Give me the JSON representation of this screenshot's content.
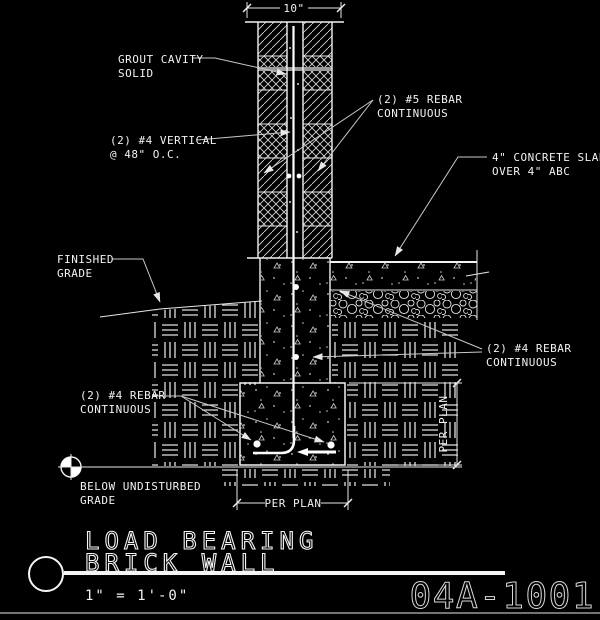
{
  "title_block": {
    "detail_title_line1": "LOAD BEARING",
    "detail_title_line2": "BRICK WALL",
    "scale": "1\" = 1'-0\"",
    "sheet_number": "04A-1001"
  },
  "dimensions": {
    "wall_width": "10\"",
    "footing_width": "PER PLAN",
    "footing_depth": "PER PLAN"
  },
  "callouts": {
    "grout": {
      "l1": "GROUT CAVITY",
      "l2": "SOLID"
    },
    "rebar5": {
      "l1": "(2) #5 REBAR",
      "l2": "CONTINUOUS"
    },
    "vert4": {
      "l1": "(2) #4 VERTICAL",
      "l2": "@ 48\" O.C."
    },
    "slab": {
      "l1": "4\" CONCRETE SLAB",
      "l2": "OVER 4\" ABC"
    },
    "fin_grade": {
      "l1": "FINISHED",
      "l2": "GRADE"
    },
    "rebar4_right": {
      "l1": "(2) #4 REBAR",
      "l2": "CONTINUOUS"
    },
    "rebar4_left": {
      "l1": "(2) #4 REBAR",
      "l2": "CONTINUOUS"
    },
    "below_grade": {
      "l1": "BELOW UNDISTURBED",
      "l2": "GRADE"
    }
  },
  "colors": {
    "background": "#000000",
    "line": "#f2f2f2",
    "joint_gray": "#999999"
  }
}
